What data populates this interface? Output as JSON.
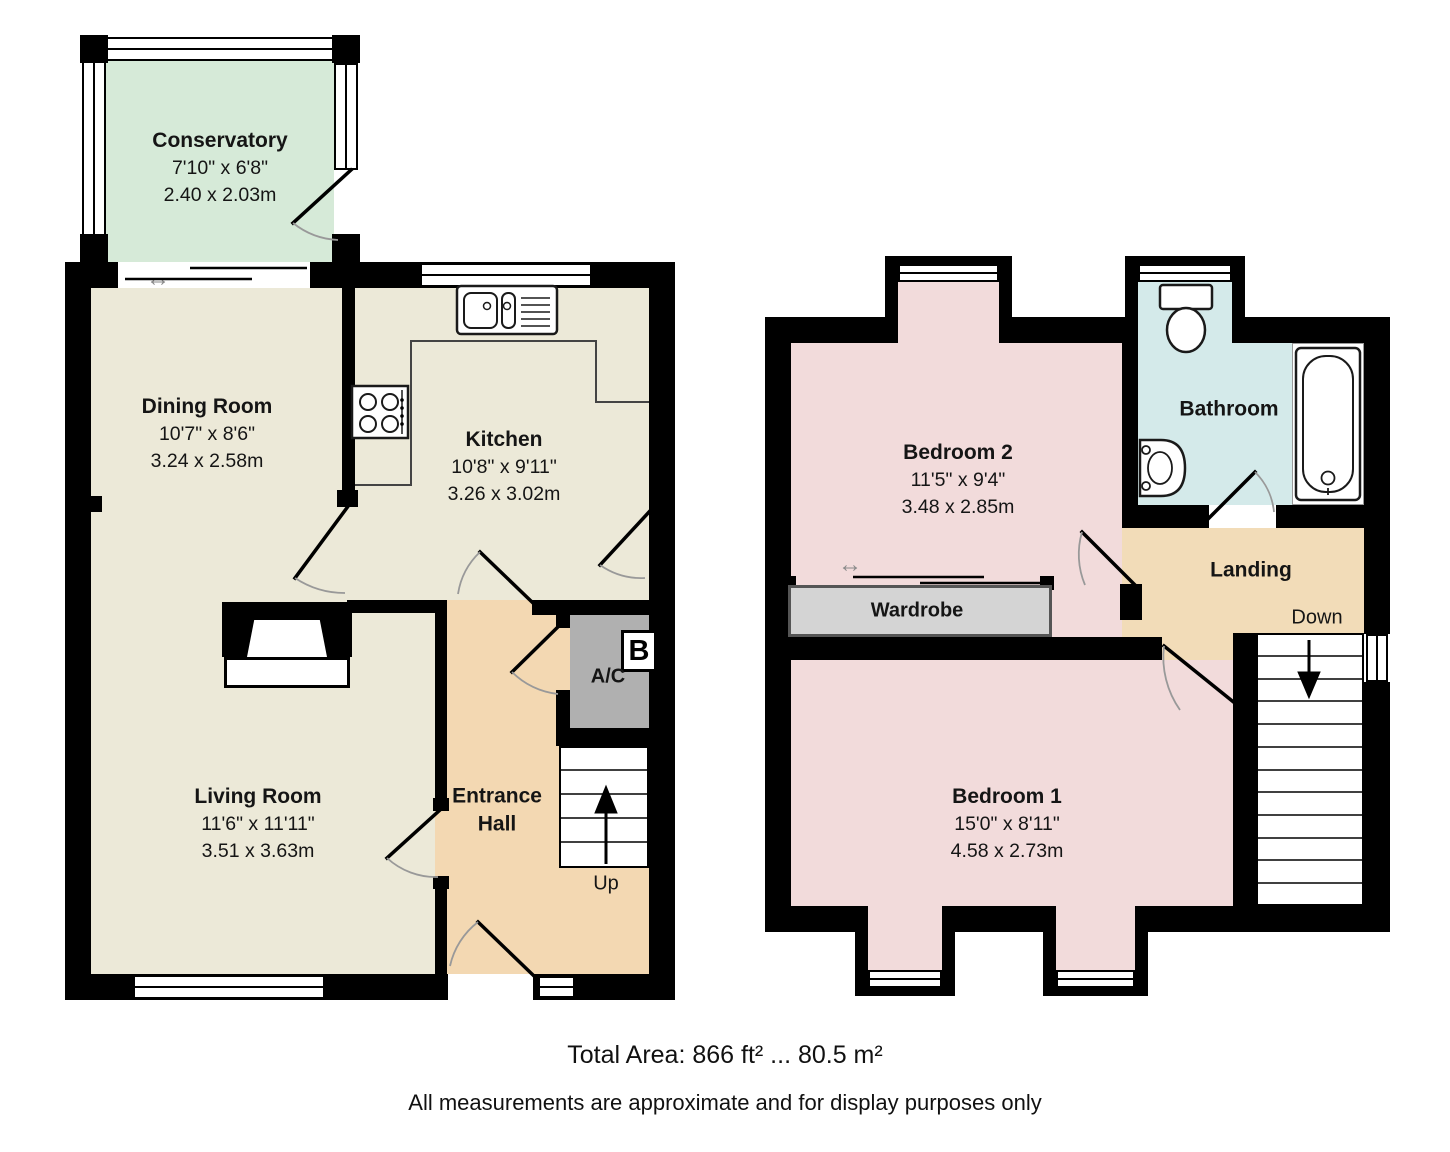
{
  "floorplan": {
    "rooms": {
      "conservatory": {
        "name": "Conservatory",
        "imperial": "7'10\" x 6'8\"",
        "metric": "2.40 x 2.03m"
      },
      "dining_room": {
        "name": "Dining Room",
        "imperial": "10'7\" x 8'6\"",
        "metric": "3.24 x 2.58m"
      },
      "kitchen": {
        "name": "Kitchen",
        "imperial": "10'8\" x 9'11\"",
        "metric": "3.26 x 3.02m"
      },
      "living_room": {
        "name": "Living Room",
        "imperial": "11'6\" x 11'11\"",
        "metric": "3.51 x 3.63m"
      },
      "entrance_hall": {
        "name_line1": "Entrance",
        "name_line2": "Hall"
      },
      "bedroom_2": {
        "name": "Bedroom 2",
        "imperial": "11'5\" x 9'4\"",
        "metric": "3.48 x 2.85m"
      },
      "bedroom_1": {
        "name": "Bedroom 1",
        "imperial": "15'0\" x 8'11\"",
        "metric": "4.58 x 2.73m"
      },
      "bathroom": {
        "name": "Bathroom"
      },
      "landing": {
        "name": "Landing"
      },
      "wardrobe": {
        "name": "Wardrobe"
      },
      "airing_cupboard": {
        "name": "A/C",
        "boiler_label": "B"
      }
    },
    "stairs": {
      "up_label": "Up",
      "down_label": "Down"
    },
    "footer": {
      "total_area": "Total Area: 866 ft² ... 80.5 m²",
      "disclaimer": "All measurements are approximate and for display purposes only"
    },
    "colors": {
      "wall": "#000000",
      "room_beige": "#ECE9D8",
      "conservatory_green": "#D6EAD8",
      "hall_tan": "#F3D8B2",
      "landing_tan": "#F2DCB8",
      "bedroom_pink": "#F2DBDB",
      "bathroom_blue": "#D4EAEA",
      "wardrobe_grey": "#D4D4D4",
      "cupboard_grey": "#B0B0B0"
    }
  }
}
